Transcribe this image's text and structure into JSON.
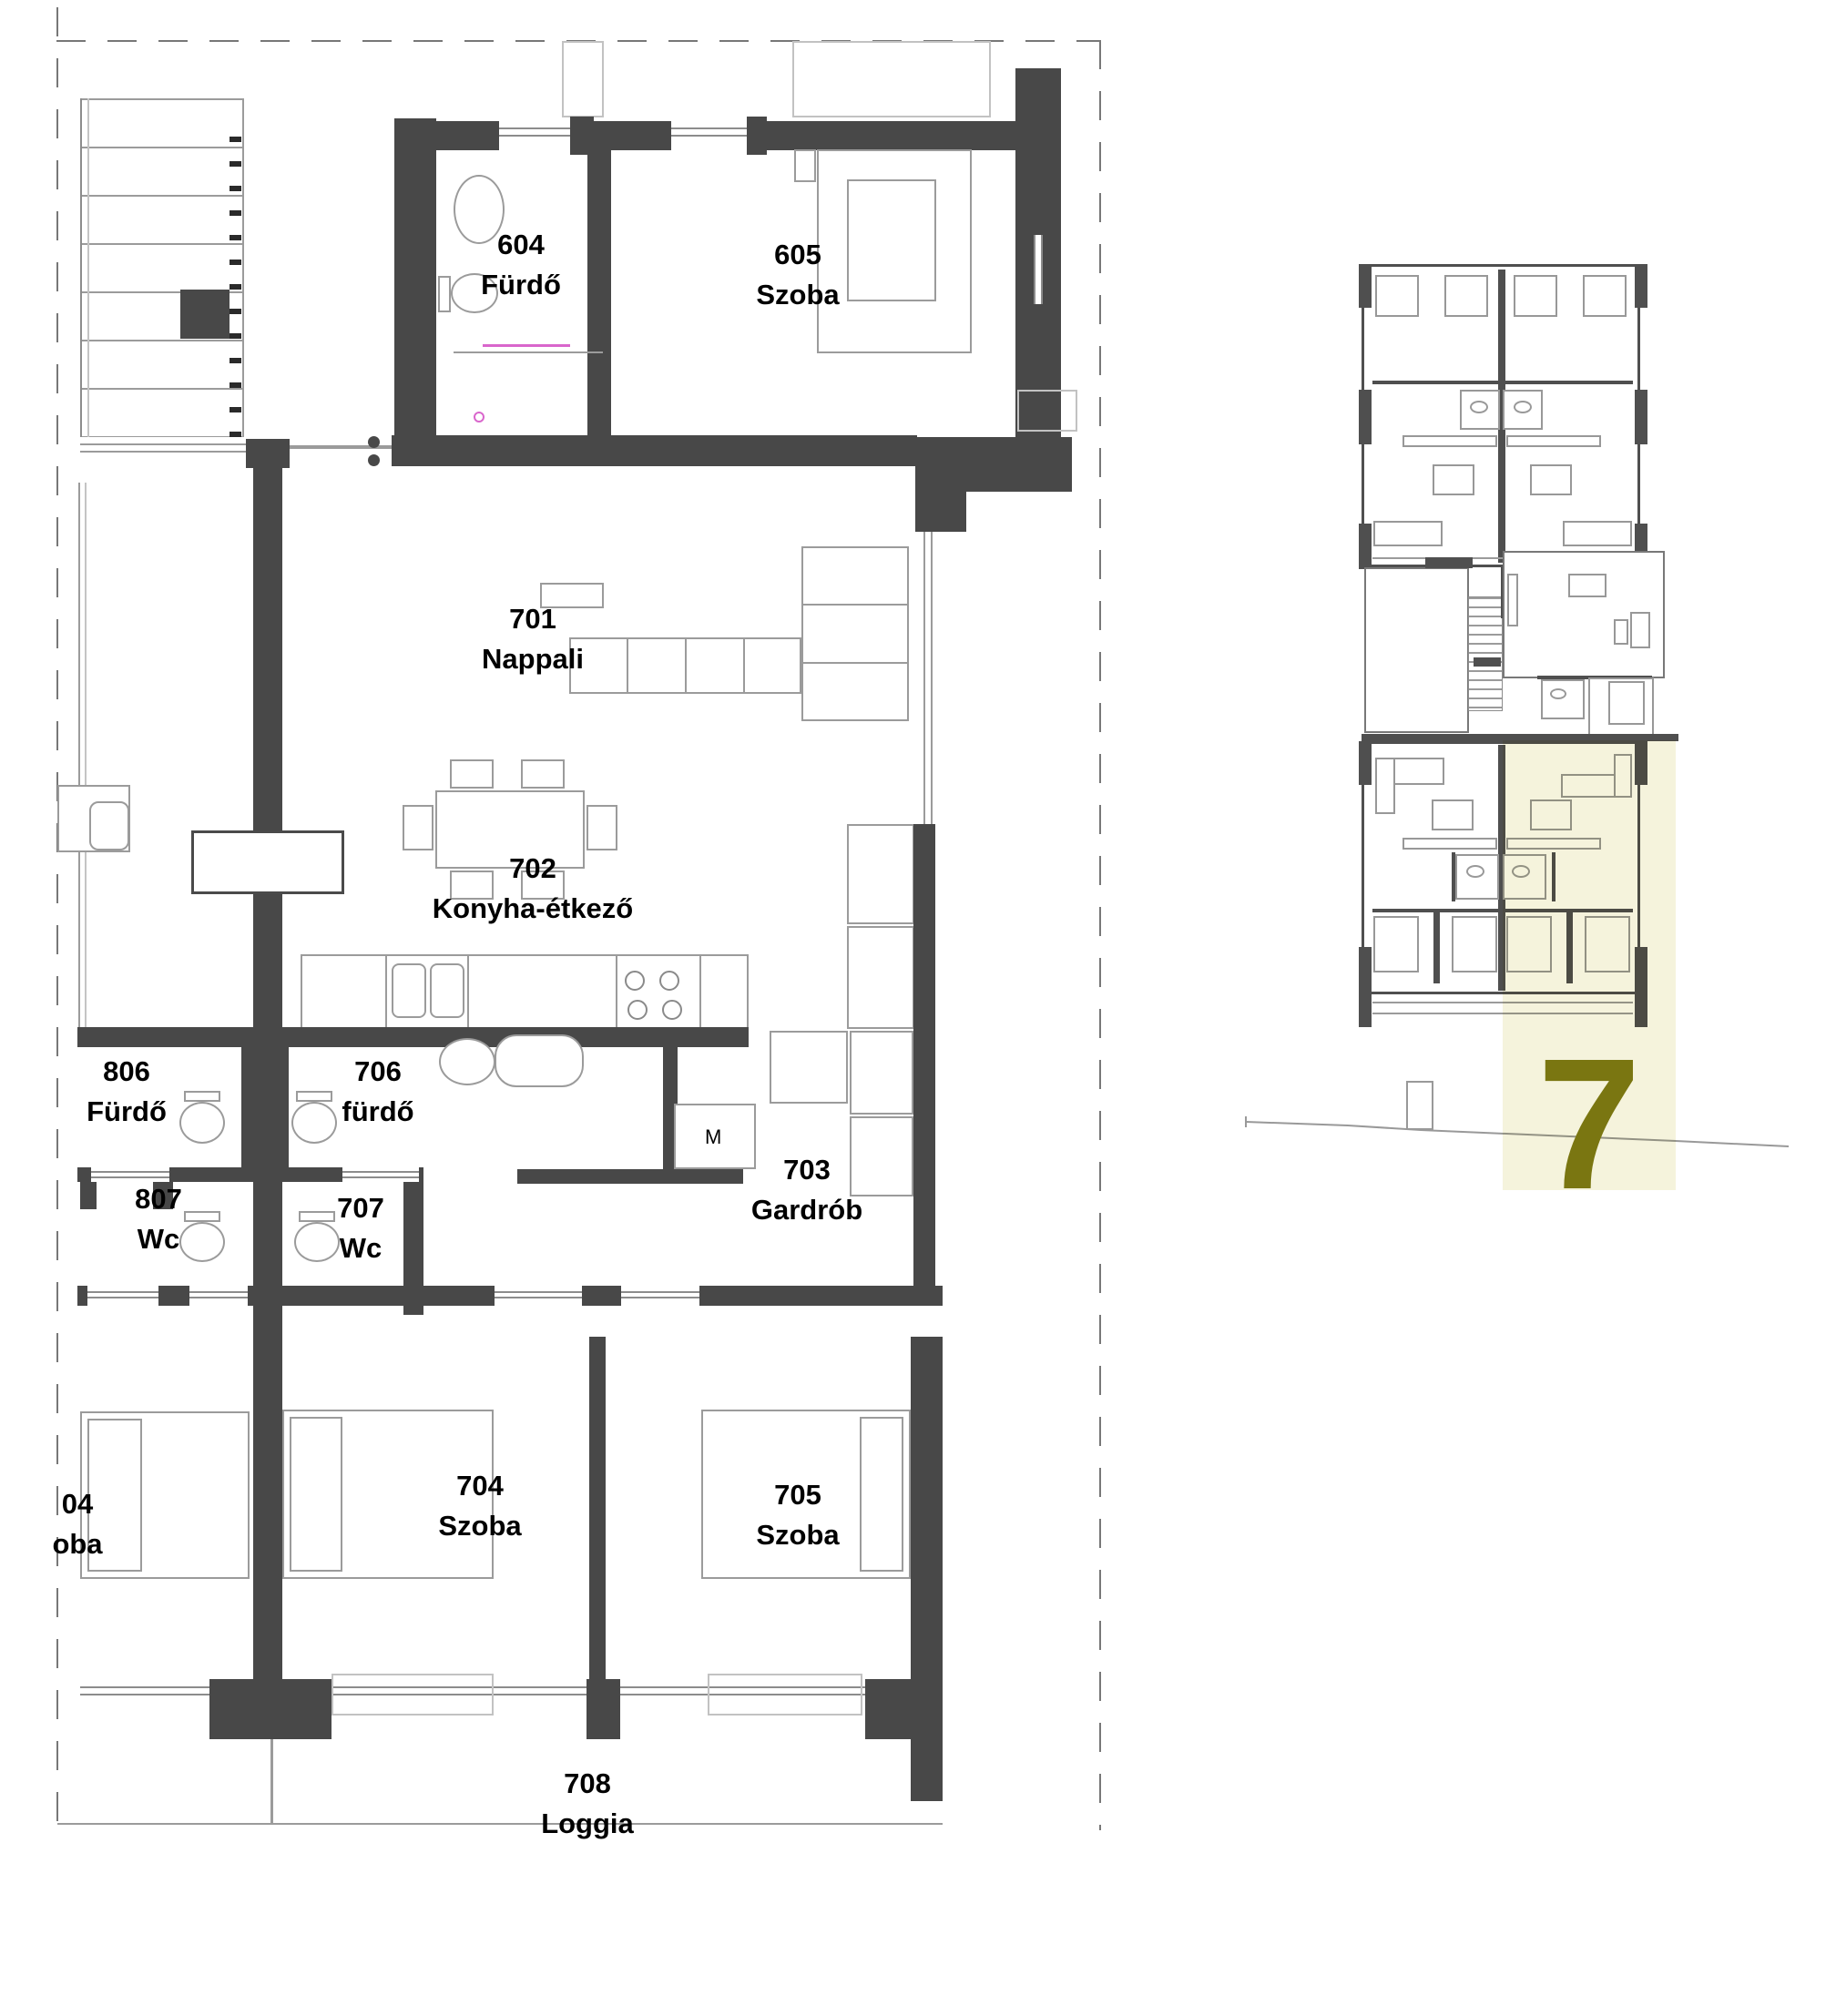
{
  "main_plan": {
    "rooms": {
      "r604": {
        "number": "604",
        "name": "Fürdő"
      },
      "r605": {
        "number": "605",
        "name": "Szoba"
      },
      "r701": {
        "number": "701",
        "name": "Nappali"
      },
      "r702": {
        "number": "702",
        "name": "Konyha-étkező"
      },
      "r806": {
        "number": "806",
        "name": "Fürdő"
      },
      "r706": {
        "number": "706",
        "name": "fürdő"
      },
      "r807": {
        "number": "807",
        "name": "Wc"
      },
      "r707": {
        "number": "707",
        "name": "Wc"
      },
      "r703": {
        "number": "703",
        "name": "Gardrób"
      },
      "r704": {
        "number": "704",
        "name": "Szoba"
      },
      "r705": {
        "number": "705",
        "name": "Szoba"
      },
      "r708": {
        "number": "708",
        "name": "Loggia"
      },
      "r804_clipped": {
        "number": "04",
        "name": "oba"
      }
    },
    "appliance_labels": {
      "washing_machine": "M"
    }
  },
  "key_plan": {
    "selected_unit_number": "7"
  },
  "colors": {
    "wall": "#484848",
    "outline": "#9b9b9b",
    "highlight": "#f5f3dc",
    "accent_olive": "#7a7611",
    "magenta": "#d966cc"
  }
}
